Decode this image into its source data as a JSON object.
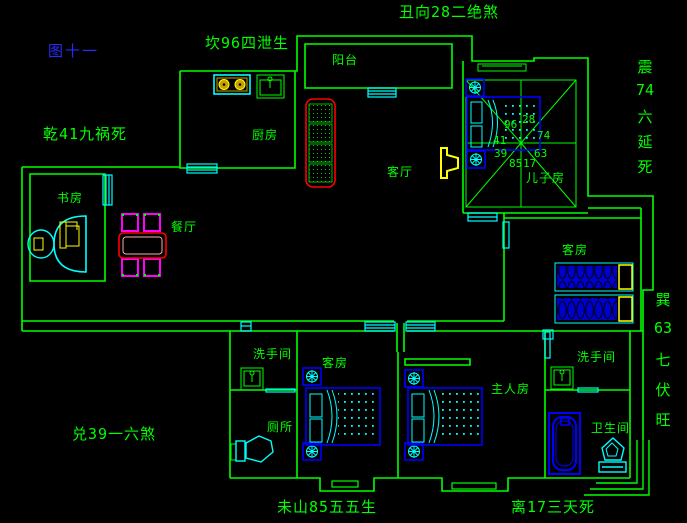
{
  "figure_label": "图十一",
  "perimeter": {
    "north": "坎96四泄生",
    "northeast": "丑向28二绝煞",
    "east_upper": [
      "震",
      "74",
      "六",
      "延",
      "死"
    ],
    "east_lower": [
      "巽",
      "63",
      "七",
      "伏",
      "旺"
    ],
    "west_upper": "乾41九祸死",
    "west_lower": "兑39一六煞",
    "south_west": "未山85五五生",
    "south_east": "离17三天死"
  },
  "rooms": {
    "balcony": "阳台",
    "kitchen": "厨房",
    "living_room": "客厅",
    "study": "书房",
    "dining": "餐厅",
    "son_room": "儿子房",
    "guest_room_east": "客房",
    "guest_room_south": "客房",
    "washroom_west": "洗手间",
    "toilet_room": "厕所",
    "master_room": "主人房",
    "washroom_east": "洗手间",
    "bathroom": "卫生间"
  },
  "compass_numbers": {
    "nw": "96",
    "ne": "28",
    "w": "41",
    "e": "74",
    "wsw": "39",
    "ese": "63",
    "sw": "85",
    "se": "17"
  },
  "colors": {
    "background": "#000000",
    "wall_green": "#00ff00",
    "window_cyan": "#00ffff",
    "furniture_blue": "#0000ff",
    "accent_yellow": "#ffff00",
    "sofa_red": "#ff0000",
    "chair_magenta": "#ff00ff",
    "figure_blue": "#2a2aff"
  }
}
